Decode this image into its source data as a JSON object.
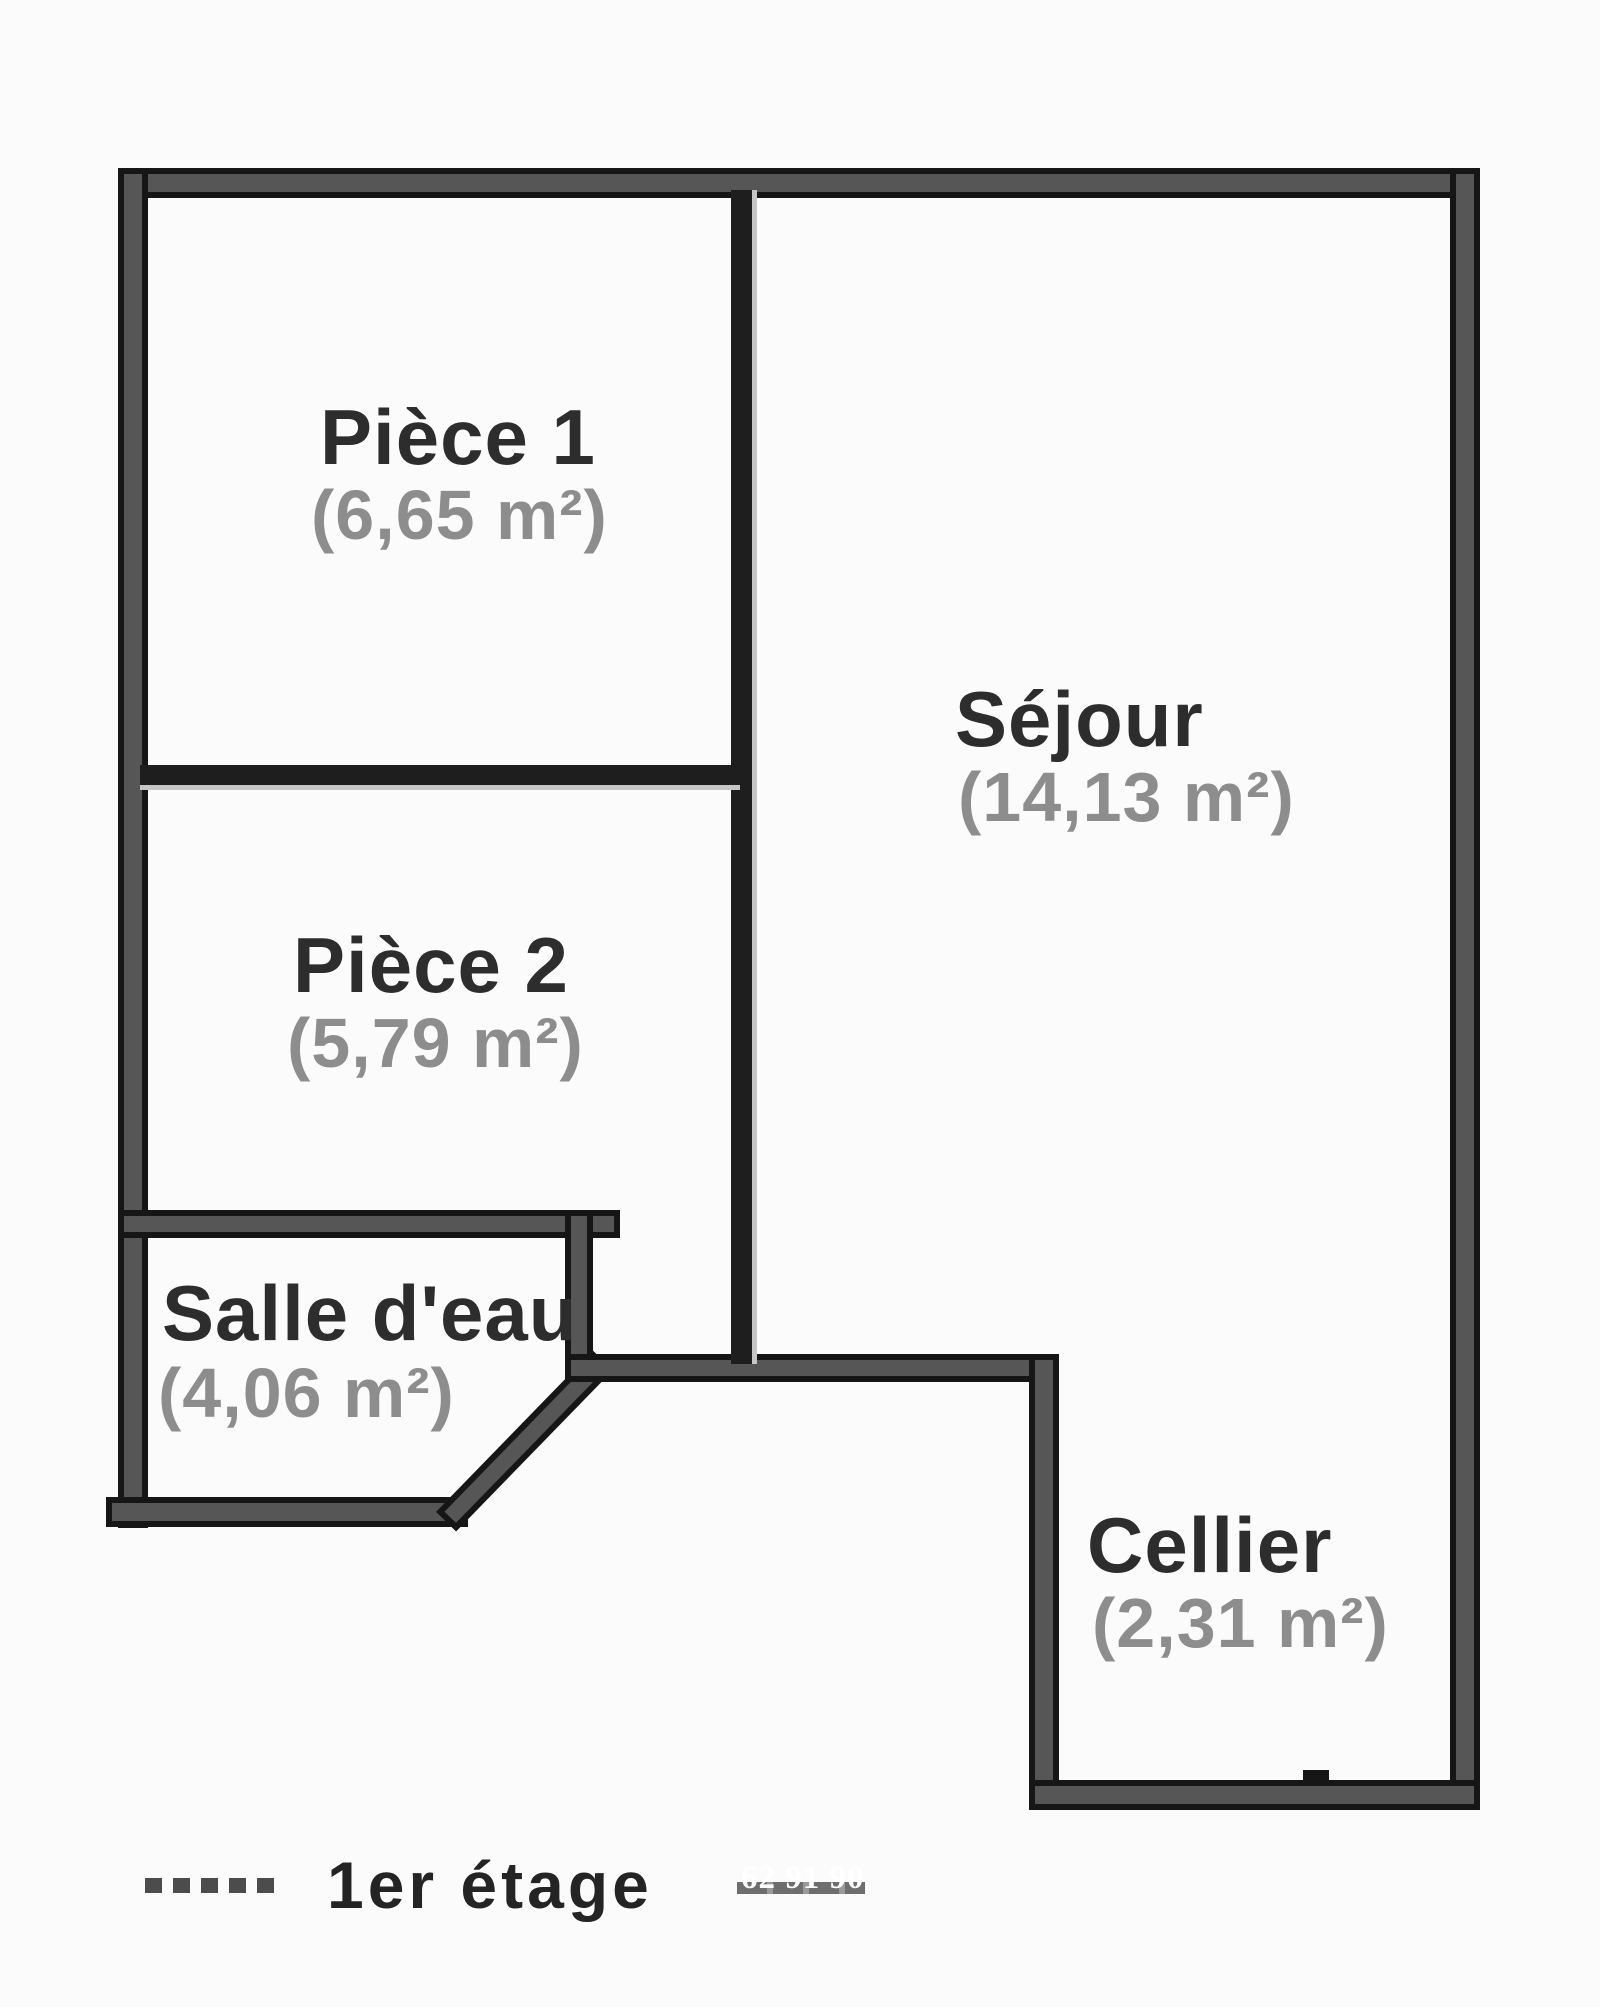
{
  "plan": {
    "legend": {
      "floor_label": "1er étage",
      "watermark": "62 91 90"
    },
    "rooms": [
      {
        "id": "piece1",
        "name": "Pièce 1",
        "area": "(6,65 m²)"
      },
      {
        "id": "piece2",
        "name": "Pièce 2",
        "area": "(5,79 m²)"
      },
      {
        "id": "sejour",
        "name": "Séjour",
        "area": "(14,13 m²)"
      },
      {
        "id": "salle-deau",
        "name": "Salle d'eau",
        "area": "(4,06 m²)"
      },
      {
        "id": "cellier",
        "name": "Cellier",
        "area": "(2,31 m²)"
      }
    ],
    "colors": {
      "wall_fill": "#565656",
      "wall_edge": "#161616",
      "partition": "#1e1e1e",
      "partition_hl": "#c6c6c6",
      "room_name": "#2d2d2d",
      "room_area": "#8d8d8d",
      "background": "#fbfbfb",
      "legend_text": "#242424",
      "legend_dash": "#4c4c4c",
      "watermark_dash": "#6e6e6e",
      "watermark_text": "#ffffff"
    }
  }
}
